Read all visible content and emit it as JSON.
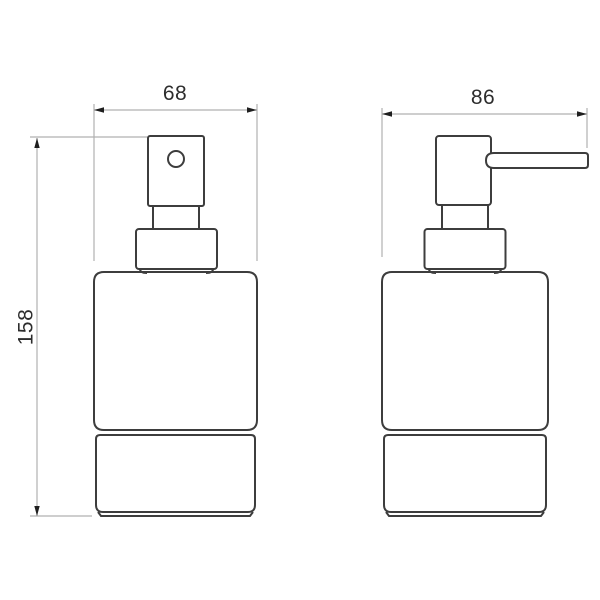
{
  "drawing": {
    "kind": "technical dimension drawing",
    "views": {
      "front": {
        "label": ""
      },
      "side": {
        "label": ""
      }
    }
  },
  "dimensions": {
    "front_width": "68",
    "side_depth": "86",
    "height": "158"
  },
  "colors": {
    "object_line": "#3d3d3d",
    "dimension_line": "#b1b1b1",
    "arrow": "#1f1f1f",
    "label_text": "#2d2d2d",
    "background": "#ffffff"
  }
}
